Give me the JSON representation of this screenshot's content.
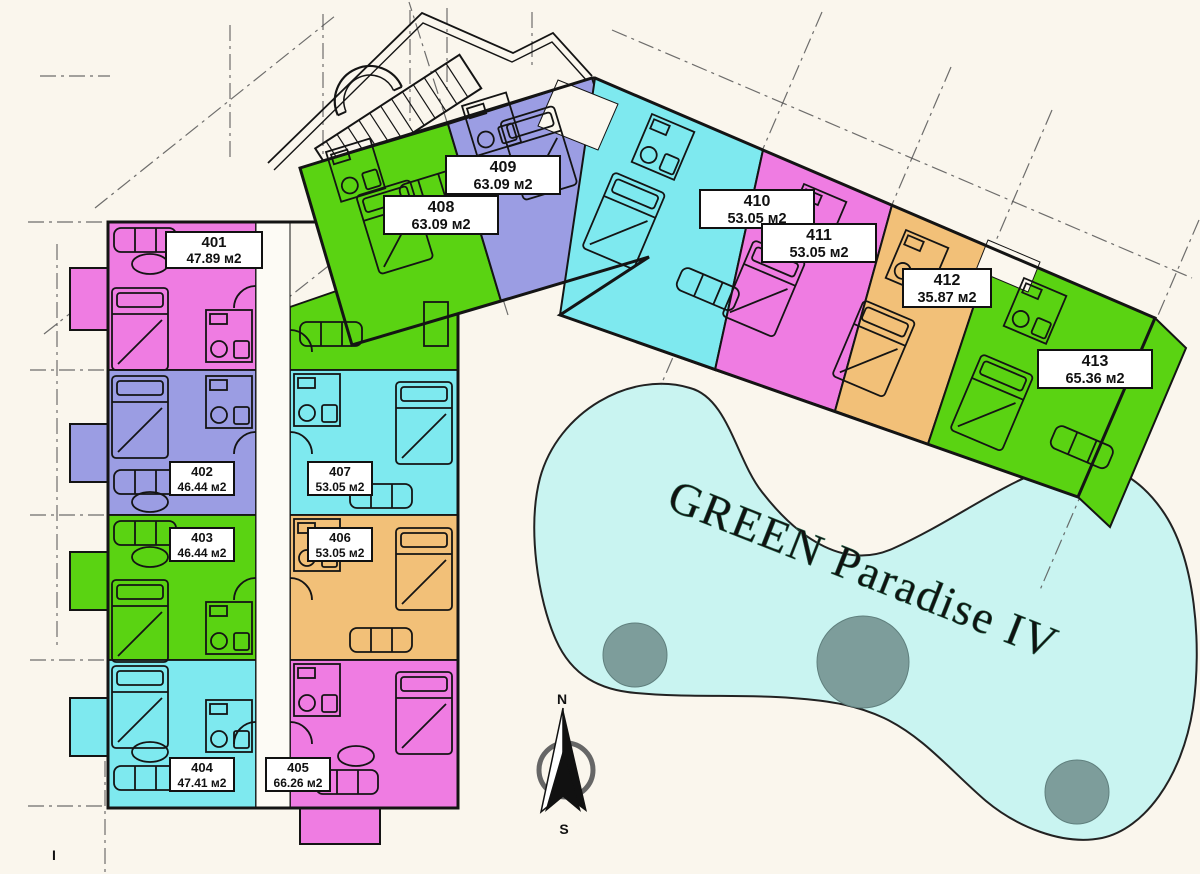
{
  "title": "GREEN Paradise IV",
  "compass": {
    "north": "N",
    "south": "S"
  },
  "corner_tick": "I",
  "area_unit": "м2",
  "units": [
    {
      "id": "401",
      "area": "47.89 м2",
      "color": "pink"
    },
    {
      "id": "402",
      "area": "46.44 м2",
      "color": "purple"
    },
    {
      "id": "403",
      "area": "46.44 м2",
      "color": "green"
    },
    {
      "id": "404",
      "area": "47.41 м2",
      "color": "cyan"
    },
    {
      "id": "405",
      "area": "66.26 м2",
      "color": "pink"
    },
    {
      "id": "406",
      "area": "53.05 м2",
      "color": "orange"
    },
    {
      "id": "407",
      "area": "53.05 м2",
      "color": "cyan"
    },
    {
      "id": "408",
      "area": "63.09 м2",
      "color": "green"
    },
    {
      "id": "409",
      "area": "63.09 м2",
      "color": "purple"
    },
    {
      "id": "410",
      "area": "53.05 м2",
      "color": "cyan"
    },
    {
      "id": "411",
      "area": "53.05 м2",
      "color": "pink"
    },
    {
      "id": "412",
      "area": "35.87 м2",
      "color": "orange"
    },
    {
      "id": "413",
      "area": "65.36 м2",
      "color": "green"
    }
  ],
  "colors": {
    "pink": "#ef7ce2",
    "purple": "#9b9de3",
    "green": "#5ad312",
    "cyan": "#7ee9ef",
    "orange": "#f2c078",
    "pool_water": "#c9f4f1",
    "pool_island": "#7d9d9b",
    "pool_text": "#3f8a68",
    "paper": "#faf6ed",
    "ink": "#141414"
  }
}
